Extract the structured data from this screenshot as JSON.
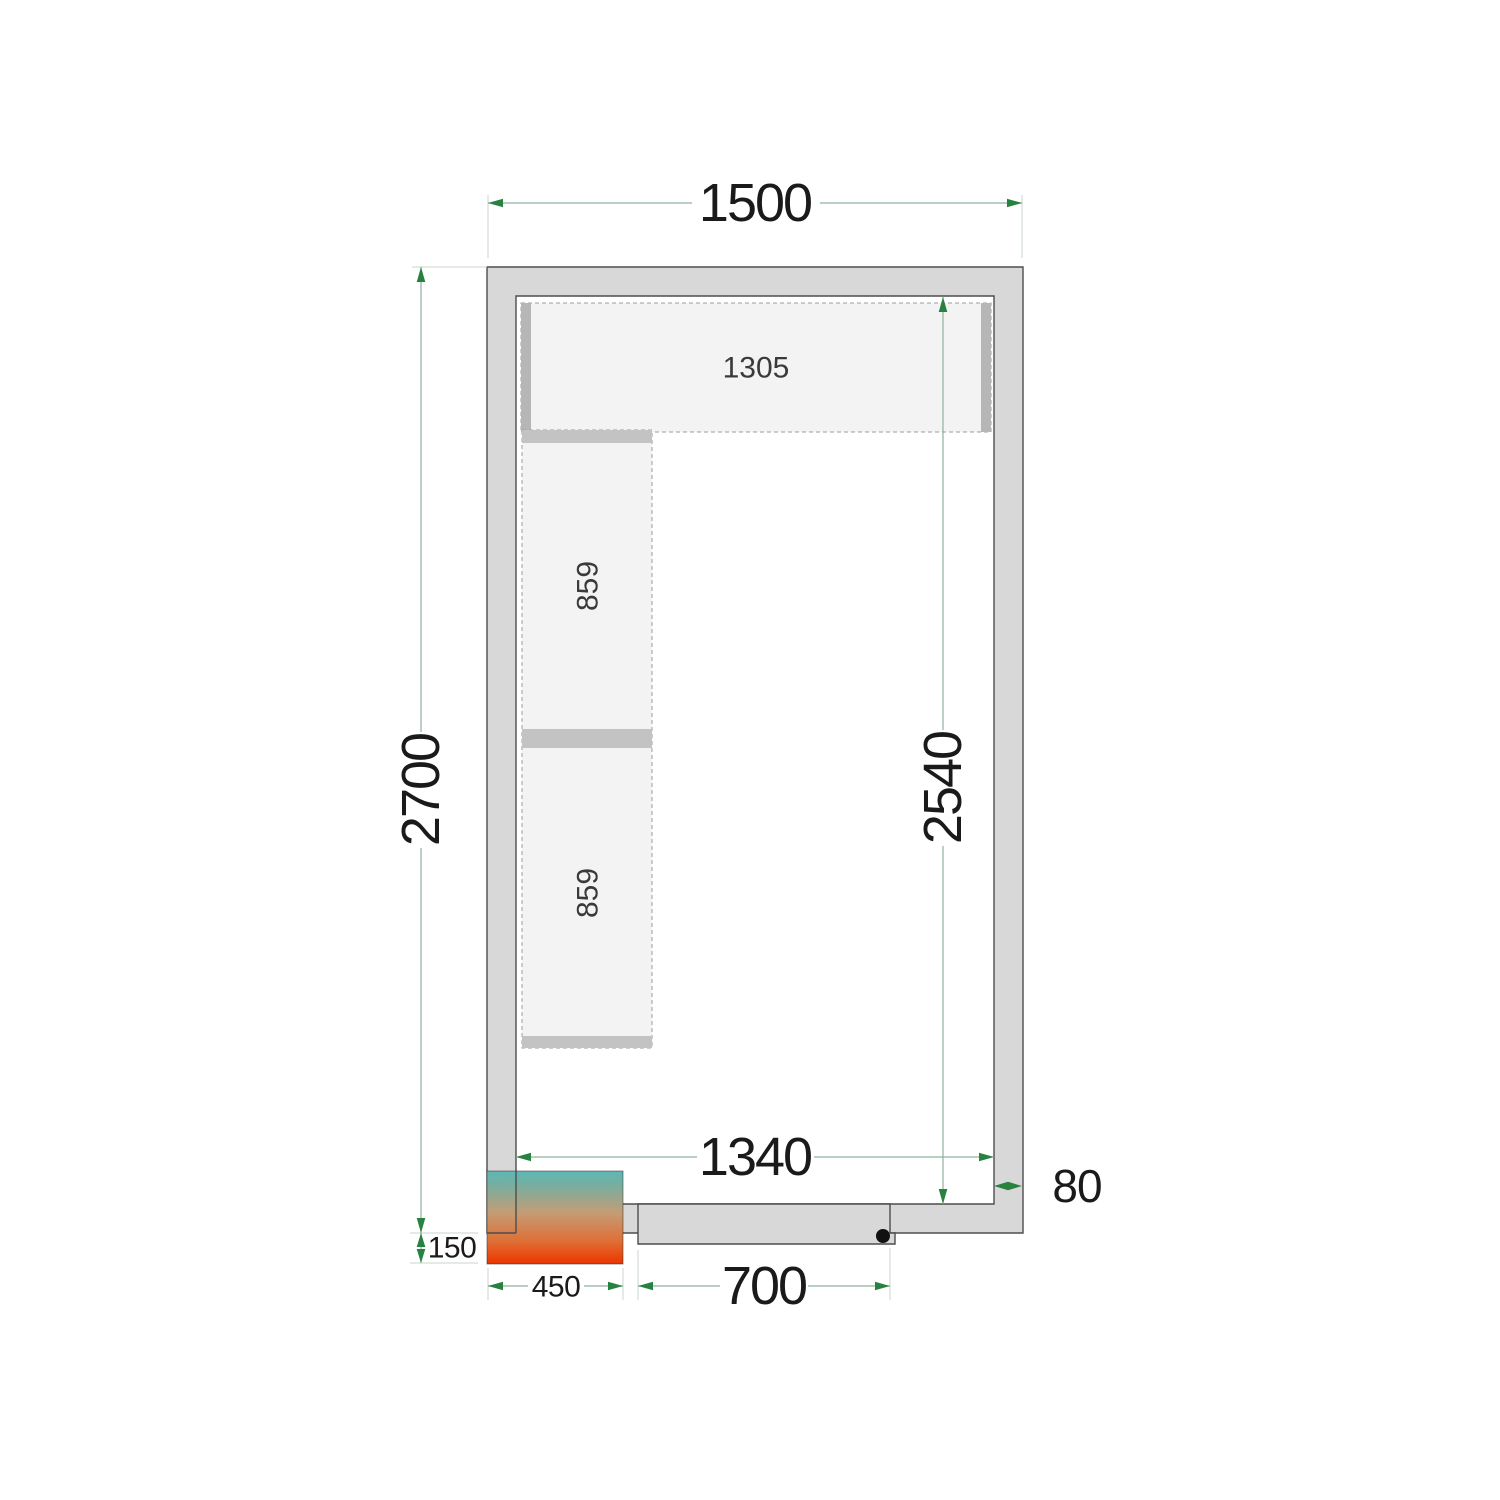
{
  "diagram": {
    "title": "cold-room-floor-plan",
    "dims": {
      "outer_width": "1500",
      "outer_depth": "2700",
      "inner_width": "1340",
      "inner_depth": "2540",
      "wall_thickness": "80",
      "door_width": "700",
      "unit_width": "450",
      "unit_offset": "150"
    },
    "shelves": {
      "top": "1305",
      "left": [
        "859",
        "859"
      ]
    },
    "colors": {
      "dimension_arrow_green": "#27813f",
      "dimension_line_green": "#8fb29c",
      "extension_line": "#c8d6cc",
      "wall_fill": "#d8d8d8",
      "wall_outline": "#4d4d4d",
      "shelf_fill": "#f3f3f3",
      "shelf_support_gray": "#b6b6b6",
      "unit_gradient_top_teal": "#5fb7b6",
      "unit_gradient_bottom_red": "#ea3505",
      "label_text": "#1a1a1a"
    }
  }
}
